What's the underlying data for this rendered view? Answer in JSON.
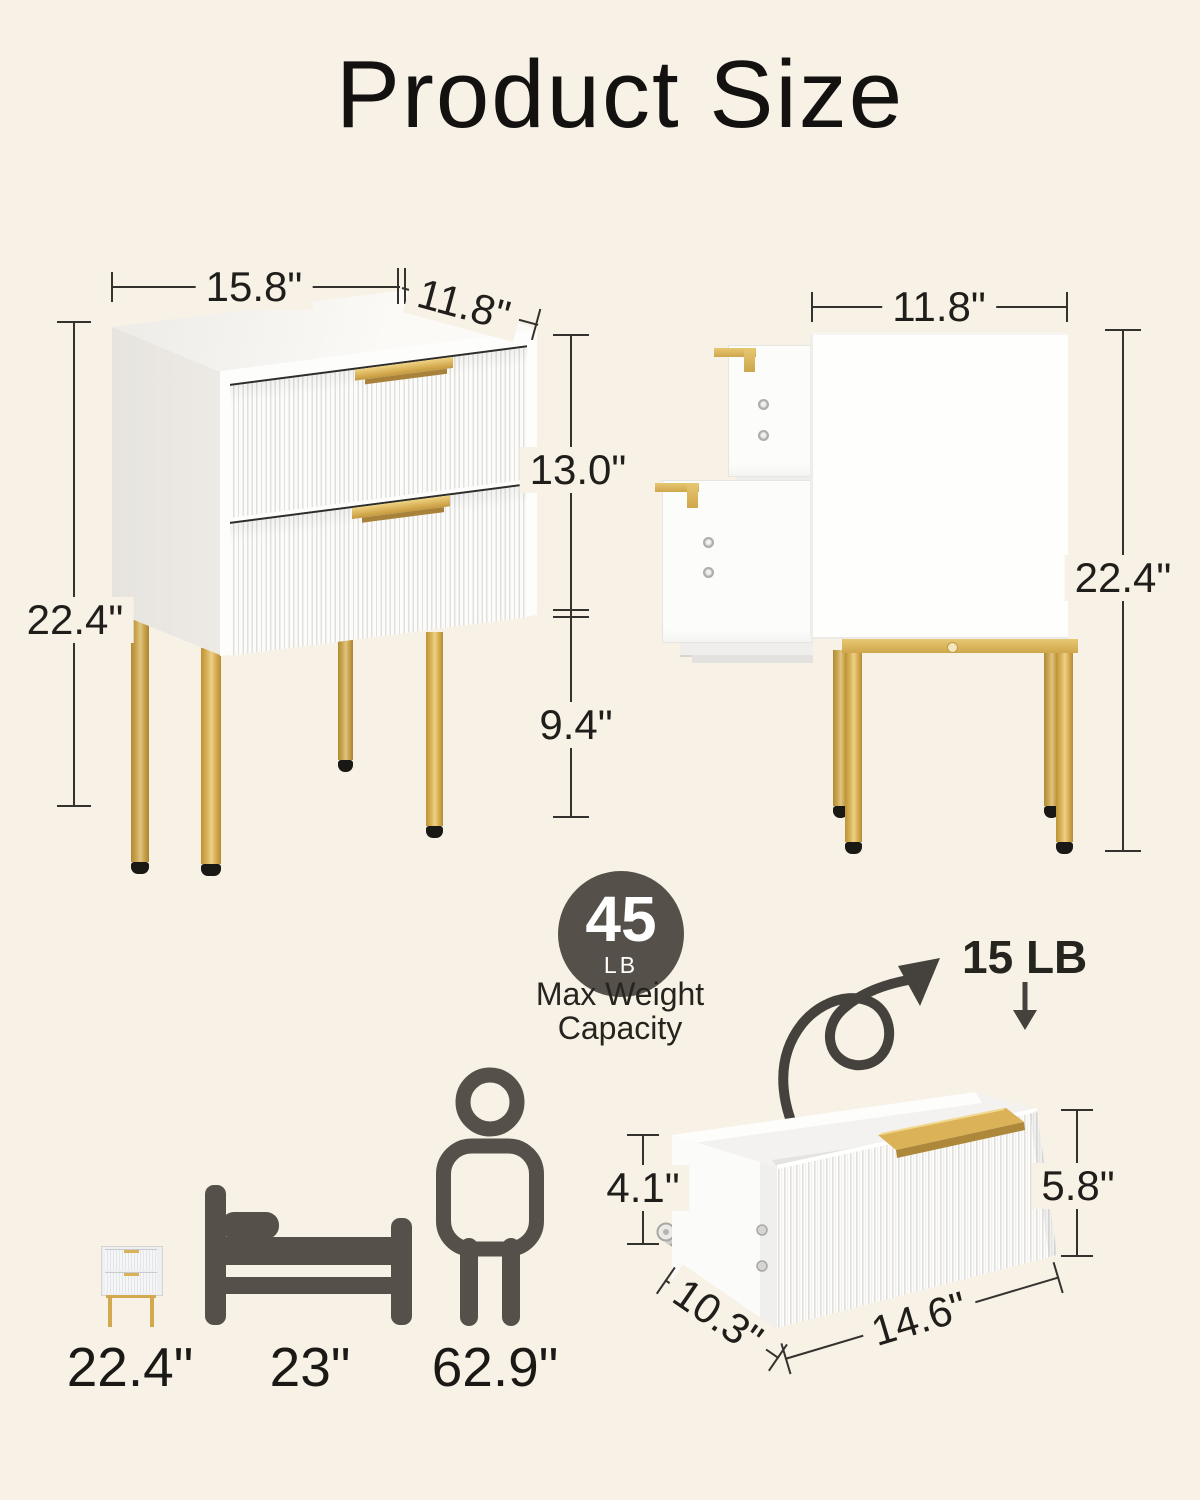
{
  "title": "Product Size",
  "front_view": {
    "width": "15.8\"",
    "depth": "11.8\"",
    "drawer_section_height": "13.0\"",
    "total_height": "22.4\"",
    "leg_height": "9.4\""
  },
  "side_view": {
    "depth": "11.8\"",
    "total_height": "22.4\""
  },
  "weight_badge": {
    "value": "45",
    "unit": "LB",
    "caption_line1": "Max Weight",
    "caption_line2": "Capacity"
  },
  "drawer_detail": {
    "load_capacity": "15 LB",
    "inner_height": "4.1\"",
    "front_height": "5.8\"",
    "depth": "10.3\"",
    "width": "14.6\""
  },
  "size_comparison": {
    "nightstand_height": "22.4\"",
    "bed_height": "23\"",
    "person_height": "62.9\""
  },
  "icons": {
    "load_arrow": "curly-arrow",
    "load_direction": "down-arrow",
    "comparison_items": [
      "nightstand",
      "bed",
      "person"
    ]
  },
  "colors": {
    "background": "#f7f1e6",
    "accent_gold": "#d9b157",
    "icon_gray": "#55514a",
    "text": "#201e1b"
  }
}
